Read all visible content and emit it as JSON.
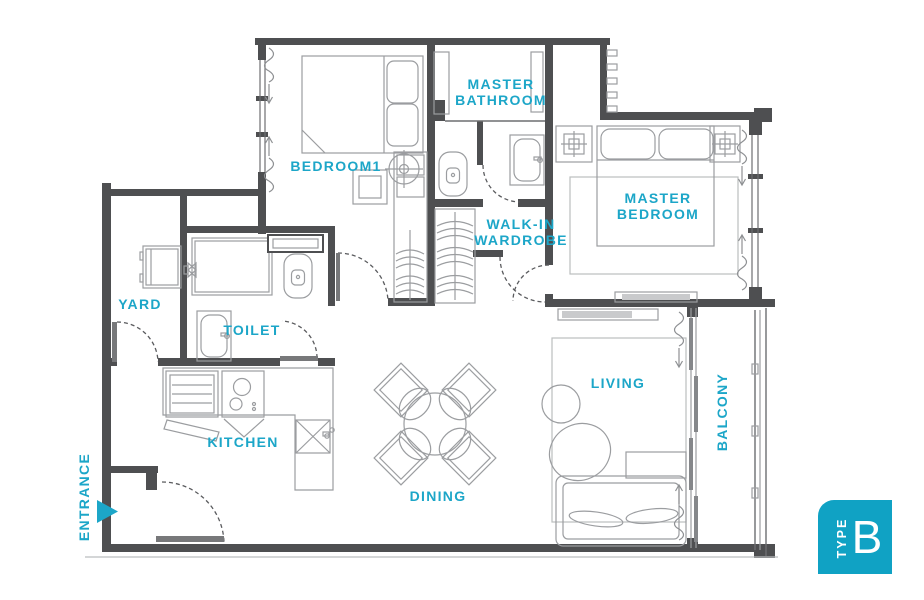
{
  "colors": {
    "accent": "#1ca6c8",
    "badge_background": "#10a2c4",
    "wall": "#4e4f51",
    "furniture": "#9b9da0",
    "light_outline": "#bbbdbf"
  },
  "rooms": {
    "bedroom1": {
      "label": "BEDROOM1"
    },
    "master_bathroom": {
      "line1": "MASTER",
      "line2": "BATHROOM"
    },
    "master_bedroom": {
      "line1": "MASTER",
      "line2": "BEDROOM"
    },
    "walk_in_wardrobe": {
      "line1": "WALK-IN",
      "line2": "WARDROBE"
    },
    "yard": {
      "label": "YARD"
    },
    "toilet": {
      "label": "TOILET"
    },
    "kitchen": {
      "label": "KITCHEN"
    },
    "dining": {
      "label": "DINING"
    },
    "living": {
      "label": "LIVING"
    },
    "balcony": {
      "label": "BALCONY"
    },
    "entrance": {
      "label": "ENTRANCE"
    }
  },
  "badge": {
    "type_label": "TYPE",
    "unit_type": "B"
  }
}
